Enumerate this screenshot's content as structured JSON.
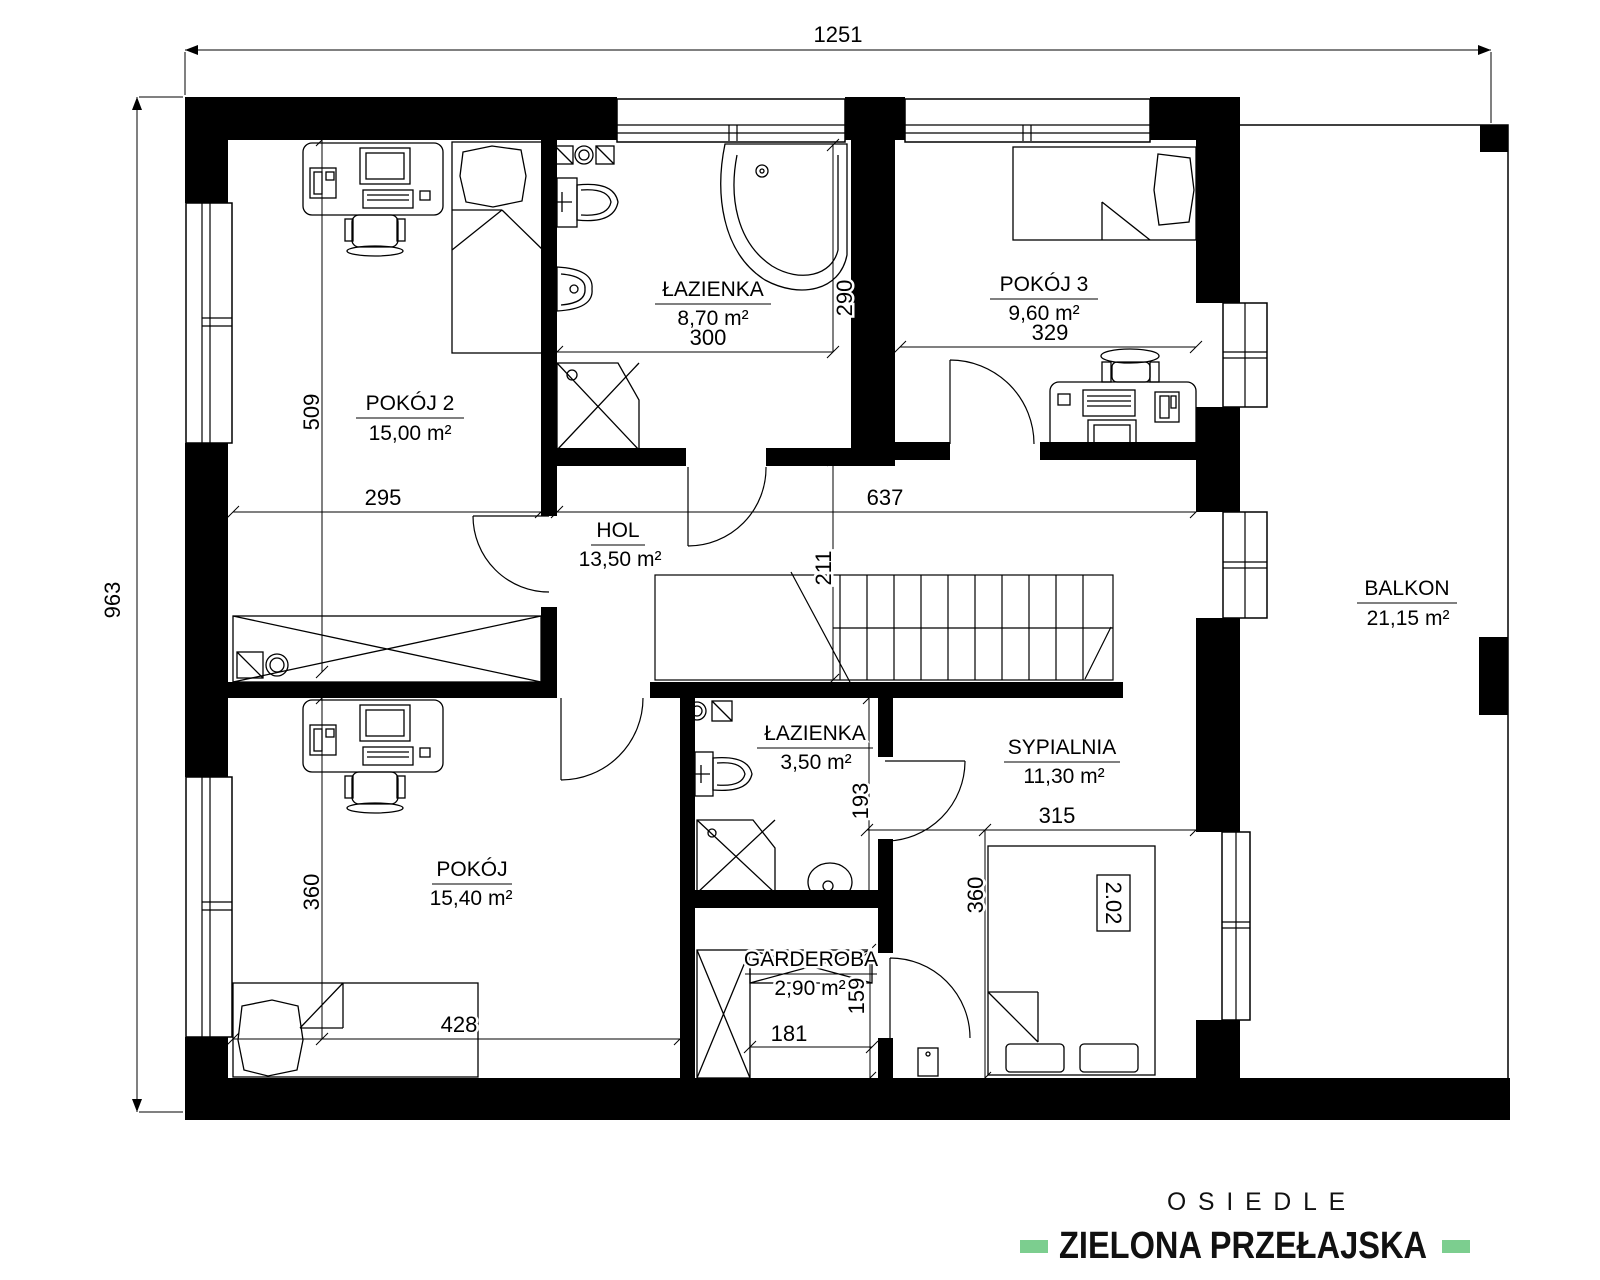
{
  "plan": {
    "total_width": "1251",
    "total_height": "963"
  },
  "rooms": {
    "pokoj2": {
      "name": "POKÓJ 2",
      "area": "15,00 m²",
      "width": "295",
      "height": "509"
    },
    "lazienka_gorna": {
      "name": "ŁAZIENKA",
      "area": "8,70 m²",
      "width": "300",
      "height": "290"
    },
    "pokoj3": {
      "name": "POKÓJ 3",
      "area": "9,60 m²",
      "width": "329"
    },
    "hol": {
      "name": "HOL",
      "area": "13,50 m²",
      "width": "637",
      "height": "211"
    },
    "balkon": {
      "name": "BALKON",
      "area": "21,15 m²"
    },
    "lazienka_dolna": {
      "name": "ŁAZIENKA",
      "area": "3,50 m²",
      "height": "193"
    },
    "sypialnia": {
      "name": "SYPIALNIA",
      "area": "11,30 m²",
      "width": "315",
      "height": "360",
      "bed_label": "2.02"
    },
    "garderoba": {
      "name": "GARDEROBA",
      "area": "2,90 m²",
      "width": "181",
      "height": "159"
    },
    "pokoj": {
      "name": "POKÓJ",
      "area": "15,40 m²",
      "width": "428",
      "height": "360"
    }
  },
  "logo": {
    "line1": "OSIEDLE",
    "line2": "ZIELONA PRZEŁAJSKA",
    "accent_color": "#7CCE8F"
  },
  "colors": {
    "ink": "#000000",
    "background": "#FFFFFF"
  }
}
